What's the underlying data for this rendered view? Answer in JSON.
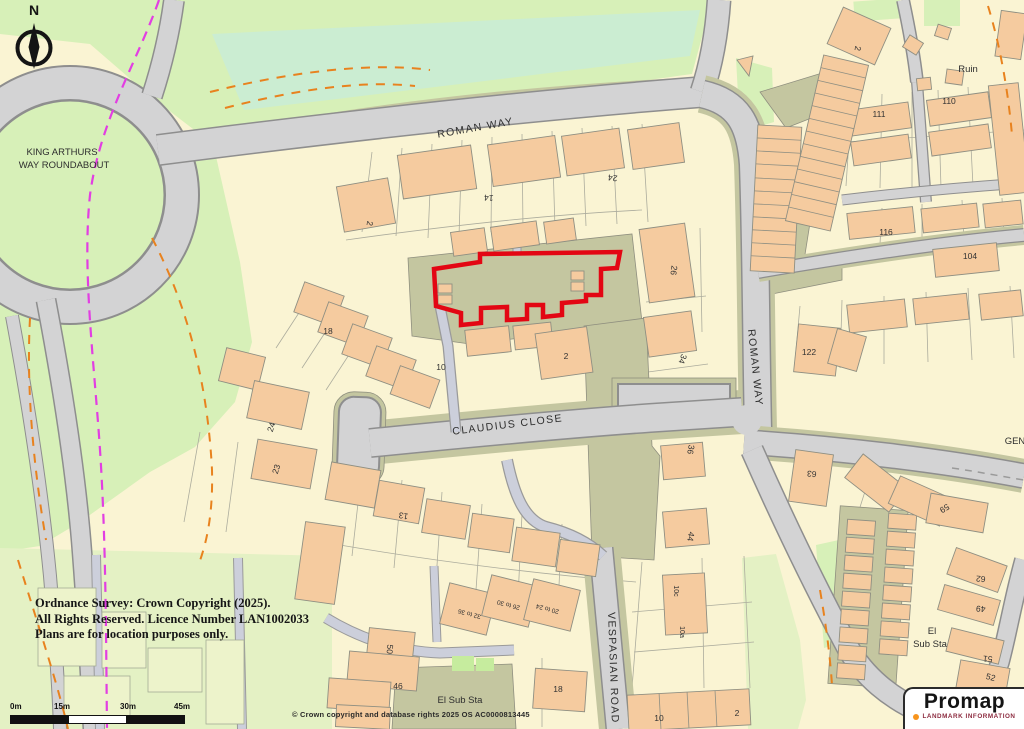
{
  "colors": {
    "parcel": "#FAF4D3",
    "green": "#D7F0B8",
    "greenpale": "#E4F1C4",
    "greenteal": "#CBEDD2",
    "road": "#D3D3D4",
    "case": "#8E8E8E",
    "lane": "#CCCFDB",
    "olive": "#C4C6A0",
    "bldg": "#F5CB9F",
    "red": "#E30613",
    "magenta": "#E23EE2",
    "orange": "#E8821E"
  },
  "compass": {
    "label": "N"
  },
  "map": {
    "site_outline_color": "#E30613",
    "street_labels": [
      {
        "text": "ROMAN WAY",
        "x": 476,
        "y": 131,
        "rot": -10
      },
      {
        "text": "ROMAN WAY",
        "x": 752,
        "y": 368,
        "rot": 84
      },
      {
        "text": "CLAUDIUS CLOSE",
        "x": 508,
        "y": 428,
        "rot": -7
      },
      {
        "text": "VESPASIAN ROAD",
        "x": 610,
        "y": 668,
        "rot": 88
      }
    ],
    "area_labels": [
      {
        "text": "KING ARTHURS",
        "x": 62,
        "y": 155
      },
      {
        "text": "WAY ROUNDABOUT",
        "x": 64,
        "y": 168
      },
      {
        "text": "Ruin",
        "x": 968,
        "y": 72
      },
      {
        "text": "El Sub Sta",
        "x": 460,
        "y": 703
      },
      {
        "text": "El",
        "x": 932,
        "y": 634
      },
      {
        "text": "Sub Sta",
        "x": 930,
        "y": 647
      },
      {
        "text": "GEN",
        "x": 1015,
        "y": 444
      }
    ],
    "house_numbers": [
      {
        "text": "2",
        "x": 367,
        "y": 223,
        "rot": 100
      },
      {
        "text": "14",
        "x": 489,
        "y": 195,
        "rot": 185
      },
      {
        "text": "24",
        "x": 613,
        "y": 175,
        "rot": 187
      },
      {
        "text": "18",
        "x": 328,
        "y": 334,
        "rot": 0
      },
      {
        "text": "10",
        "x": 441,
        "y": 370,
        "rot": 0
      },
      {
        "text": "2",
        "x": 566,
        "y": 359,
        "rot": 0
      },
      {
        "text": "26",
        "x": 671,
        "y": 270,
        "rot": 97
      },
      {
        "text": "34",
        "x": 680,
        "y": 358,
        "rot": 110
      },
      {
        "text": "36",
        "x": 688,
        "y": 449,
        "rot": 100
      },
      {
        "text": "44",
        "x": 688,
        "y": 536,
        "rot": 100
      },
      {
        "text": "24",
        "x": 274,
        "y": 428,
        "rot": -72
      },
      {
        "text": "23",
        "x": 279,
        "y": 470,
        "rot": -72
      },
      {
        "text": "13",
        "x": 404,
        "y": 513,
        "rot": 190
      },
      {
        "text": "50",
        "x": 387,
        "y": 649,
        "rot": 95
      },
      {
        "text": "46",
        "x": 398,
        "y": 689,
        "rot": 0
      },
      {
        "text": "18",
        "x": 558,
        "y": 692,
        "rot": 0
      },
      {
        "text": "10c",
        "x": 674,
        "y": 591,
        "rot": 90,
        "size": 7
      },
      {
        "text": "10a",
        "x": 680,
        "y": 632,
        "rot": 90,
        "size": 7
      },
      {
        "text": "10",
        "x": 659,
        "y": 721,
        "rot": 0
      },
      {
        "text": "2",
        "x": 737,
        "y": 716,
        "rot": 0
      },
      {
        "text": "2",
        "x": 855,
        "y": 48,
        "rot": 100
      },
      {
        "text": "111",
        "x": 879,
        "y": 117,
        "rot": 0
      },
      {
        "text": "110",
        "x": 949,
        "y": 104,
        "rot": 0
      },
      {
        "text": "116",
        "x": 886,
        "y": 235,
        "rot": 0
      },
      {
        "text": "104",
        "x": 970,
        "y": 259,
        "rot": 0
      },
      {
        "text": "122",
        "x": 809,
        "y": 355,
        "rot": 0
      },
      {
        "text": "63",
        "x": 812,
        "y": 471,
        "rot": 185
      },
      {
        "text": "59",
        "x": 943,
        "y": 506,
        "rot": 148
      },
      {
        "text": "62",
        "x": 981,
        "y": 576,
        "rot": 185
      },
      {
        "text": "49",
        "x": 981,
        "y": 606,
        "rot": 185
      },
      {
        "text": "51",
        "x": 988,
        "y": 656,
        "rot": 185
      },
      {
        "text": "52",
        "x": 990,
        "y": 680,
        "rot": 15
      },
      {
        "text": "32 to 36",
        "x": 470,
        "y": 612,
        "rot": 195,
        "size": 6.5
      },
      {
        "text": "26 to 30",
        "x": 509,
        "y": 603,
        "rot": 195,
        "size": 6.5
      },
      {
        "text": "20 to 24",
        "x": 548,
        "y": 607,
        "rot": 195,
        "size": 6.5
      }
    ]
  },
  "scale_bar": {
    "labels": [
      "0m",
      "15m",
      "30m",
      "45m"
    ]
  },
  "copyright_notice": {
    "lines": [
      "Ordnance Survey: Crown Copyright (2025).",
      "All Rights Reserved. Licence Number LAN1002033",
      "Plans are for location purposes only."
    ]
  },
  "os_attribution": "© Crown copyright and database rights 2025 OS AC0000813445",
  "logo": {
    "brand": "Promap",
    "tagline": "LANDMARK INFORMATION"
  }
}
